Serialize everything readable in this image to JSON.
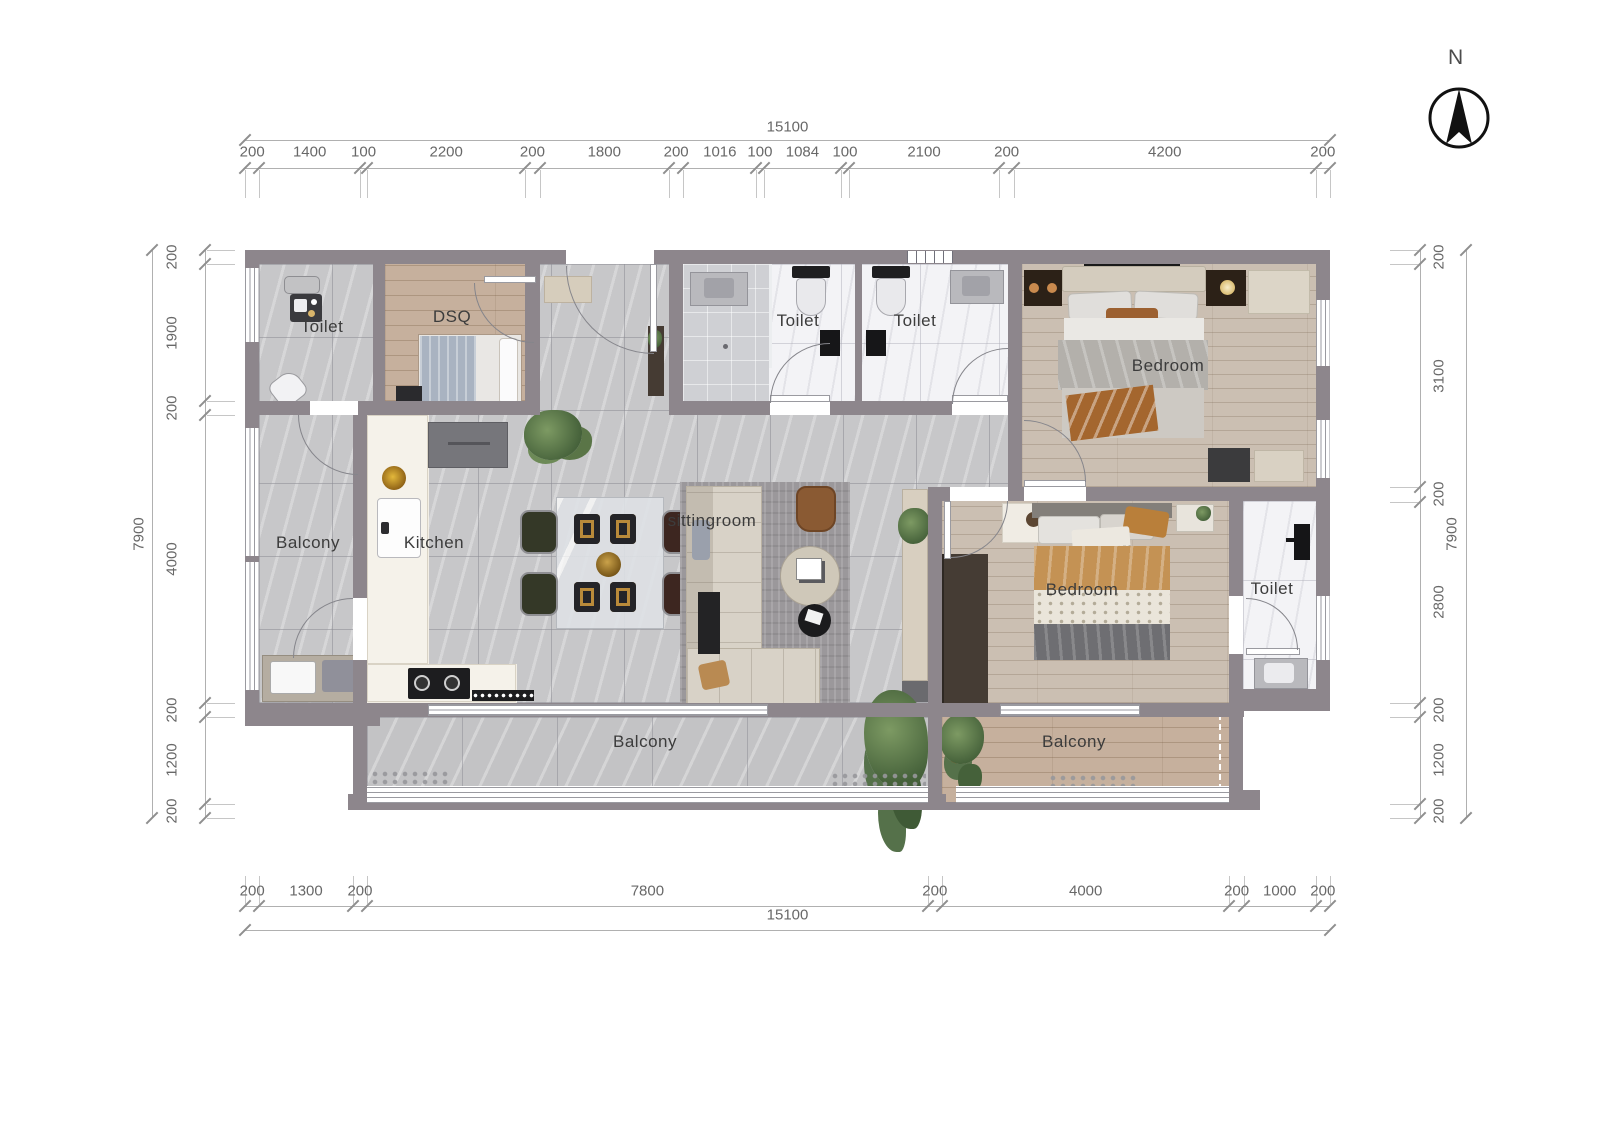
{
  "north": {
    "label": "N"
  },
  "rooms": {
    "toilet_tl": {
      "label": "Toilet"
    },
    "dsq": {
      "label": "DSQ"
    },
    "toilet_m1": {
      "label": "Toilet"
    },
    "toilet_m2": {
      "label": "Toilet"
    },
    "bedroom_tr": {
      "label": "Bedroom"
    },
    "balcony_left": {
      "label": "Balcony"
    },
    "kitchen": {
      "label": "Kitchen"
    },
    "sittingroom": {
      "label": "sittingroom"
    },
    "bedroom_br": {
      "label": "Bedroom"
    },
    "toilet_ensuite": {
      "label": "Toilet"
    },
    "balcony_bottom": {
      "label": "Balcony"
    },
    "balcony_bottom_right": {
      "label": "Balcony"
    }
  },
  "dimensions": {
    "top": {
      "total": "15100",
      "segments": [
        "200",
        "1400",
        "100",
        "2200",
        "200",
        "1800",
        "200",
        "1016",
        "100",
        "1084",
        "100",
        "2100",
        "200",
        "4200",
        "200"
      ]
    },
    "bottom": {
      "total": "15100",
      "segments": [
        "200",
        "1300",
        "200",
        "7800",
        "200",
        "4000",
        "200",
        "1000",
        "200"
      ]
    },
    "left": {
      "total": "7900",
      "segments": [
        "200",
        "1900",
        "200",
        "4000",
        "200",
        "1200",
        "200"
      ]
    },
    "right": {
      "total": "7900",
      "segments": [
        "200",
        "3100",
        "200",
        "2800",
        "200",
        "1200",
        "200"
      ]
    }
  },
  "colors": {
    "wall": "#8d868c",
    "tile_floor": "#c7c7c9",
    "wood_floor": "#c6b09d",
    "marble_floor": "#f3f3f6",
    "accent_orange": "#e8611c"
  }
}
